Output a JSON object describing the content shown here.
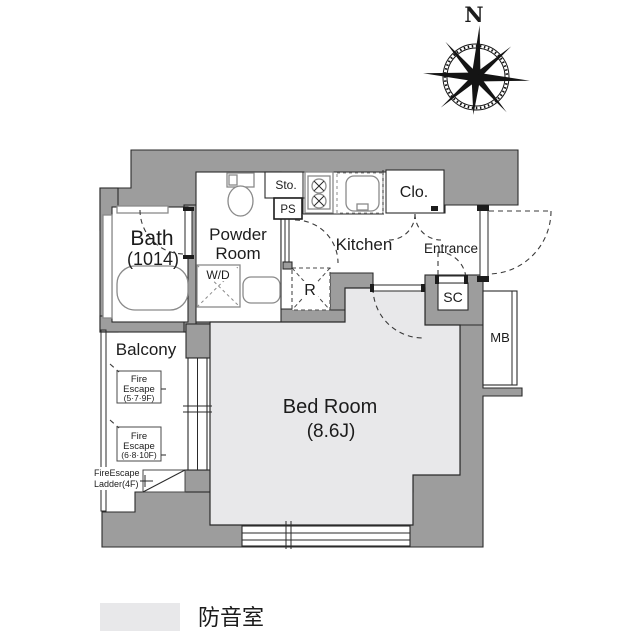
{
  "compass": {
    "north": "N"
  },
  "rooms": {
    "bath_name": "Bath",
    "bath_size": "(1014)",
    "powder_1": "Powder",
    "powder_2": "Room",
    "kitchen": "Kitchen",
    "entrance": "Entrance",
    "closet": "Clo.",
    "bedroom_name": "Bed Room",
    "bedroom_size": "(8.6J)",
    "balcony": "Balcony"
  },
  "fixtures": {
    "washer_dryer": "W/D",
    "storage": "Sto.",
    "pipe_shaft": "PS",
    "refrigerator": "R",
    "shoe_closet": "SC",
    "meter_box": "MB"
  },
  "fire_escape": {
    "box1_line1": "Fire",
    "box1_line2": "Escape",
    "box1_line3": "(5·7·9F)",
    "box2_line1": "Fire",
    "box2_line2": "Escape",
    "box2_line3": "(6·8·10F)",
    "ladder_line1": "FireEscape",
    "ladder_line2": "Ladder(4F)"
  },
  "legend": {
    "label": "防音室",
    "swatch_color": "#e8e8ea"
  },
  "colors": {
    "wall": "#9d9d9d",
    "soundproof": "#e8e8ea",
    "line": "#2a2a2a"
  }
}
